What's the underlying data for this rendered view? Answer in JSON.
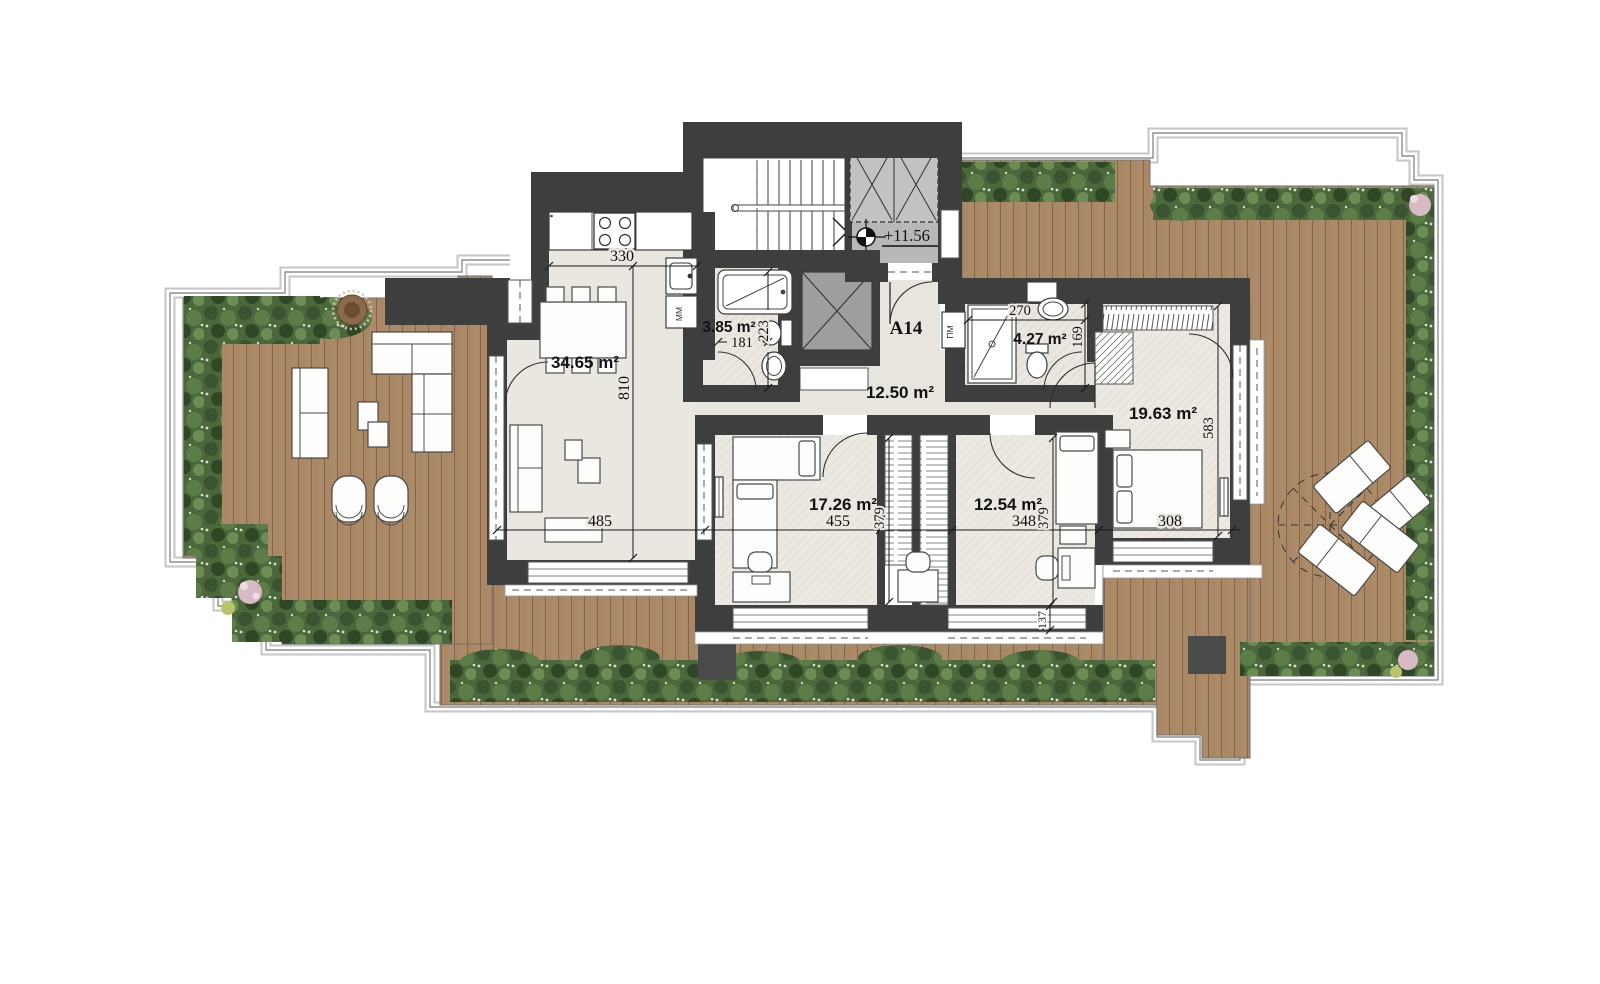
{
  "plan": {
    "unit_label": "A14",
    "elevation_label": "+11.56",
    "rooms": [
      {
        "name": "living-dining-kitchen",
        "area": "34.65 m²"
      },
      {
        "name": "bathroom-1",
        "area": "3.85 m²"
      },
      {
        "name": "hallway",
        "area": "12.50 m²"
      },
      {
        "name": "bathroom-2",
        "area": "4.27 m²"
      },
      {
        "name": "bedroom-1",
        "area": "17.26 m²"
      },
      {
        "name": "bedroom-2",
        "area": "12.54 m²"
      },
      {
        "name": "bedroom-3",
        "area": "19.63 m²"
      }
    ],
    "dimensions": {
      "living_width": "330",
      "living_depth": "810",
      "living_width2": "485",
      "bed1_width": "455",
      "bed1_depth": "379",
      "bed2_width": "348",
      "bed2_depth": "379",
      "bed3_width": "308",
      "bed3_depth": "583",
      "bath1_width": "181",
      "bath1_depth": "223",
      "bath2_width": "270",
      "bath2_depth": "169",
      "sill": "137"
    },
    "appliance_labels": {
      "kitchen_module": "MM",
      "washing_machine": "ПМ"
    },
    "colors": {
      "wall": "#3e3e3e",
      "deck": "#ac8b69",
      "plants": "#4b683c",
      "floor": "#eae7e1",
      "landing": "#b8b8b8",
      "elevator": "#9e9e9e"
    }
  }
}
